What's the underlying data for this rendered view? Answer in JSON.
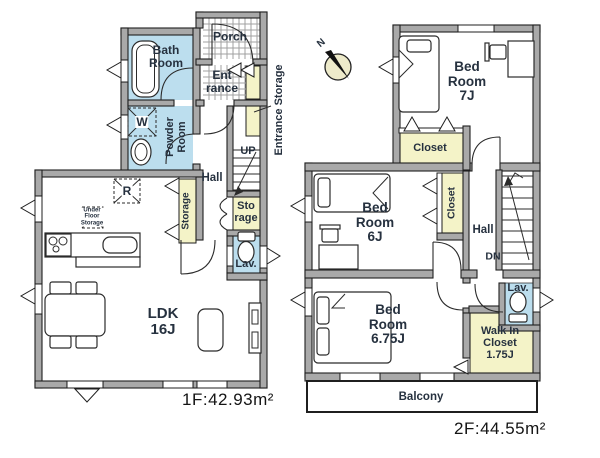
{
  "title": "Two-story house floor plan",
  "colors": {
    "wall_gray": "#a9a9a9",
    "outline": "#1f1f1f",
    "water_blue": "#bcdeee",
    "closet_yellow": "#f4f3c8",
    "compass_yellow": "#edeaca",
    "label_text": "#26313f"
  },
  "floor1": {
    "area": "1F:42.93m²",
    "bath": "Bath\nRoom",
    "porch": "Porch",
    "entrance": "Ent\nrance",
    "entrance_storage": "Entrance Storage",
    "washer": "W",
    "powder_room": "Powder\nRoom",
    "hall": "Hall",
    "up": "UP",
    "storage_closet": "Sto\nrage",
    "storage_strip": "Storage",
    "refrigerator": "R",
    "under_floor_storage": "Under\nFloor\nStorage",
    "lavatory": "Lav.",
    "ldk": "LDK\n16J"
  },
  "floor2": {
    "area": "2F:44.55m²",
    "north": "N",
    "bedroom7": "Bed\nRoom\n7J",
    "closet_7j": "Closet",
    "bedroom6": "Bed\nRoom\n6J",
    "closet_6j": "Closet",
    "hall": "Hall",
    "down": "DN",
    "lavatory": "Lav.",
    "bedroom675": "Bed\nRoom\n6.75J",
    "walk_in_closet": "Walk In\nCloset\n1.75J",
    "balcony": "Balcony"
  }
}
